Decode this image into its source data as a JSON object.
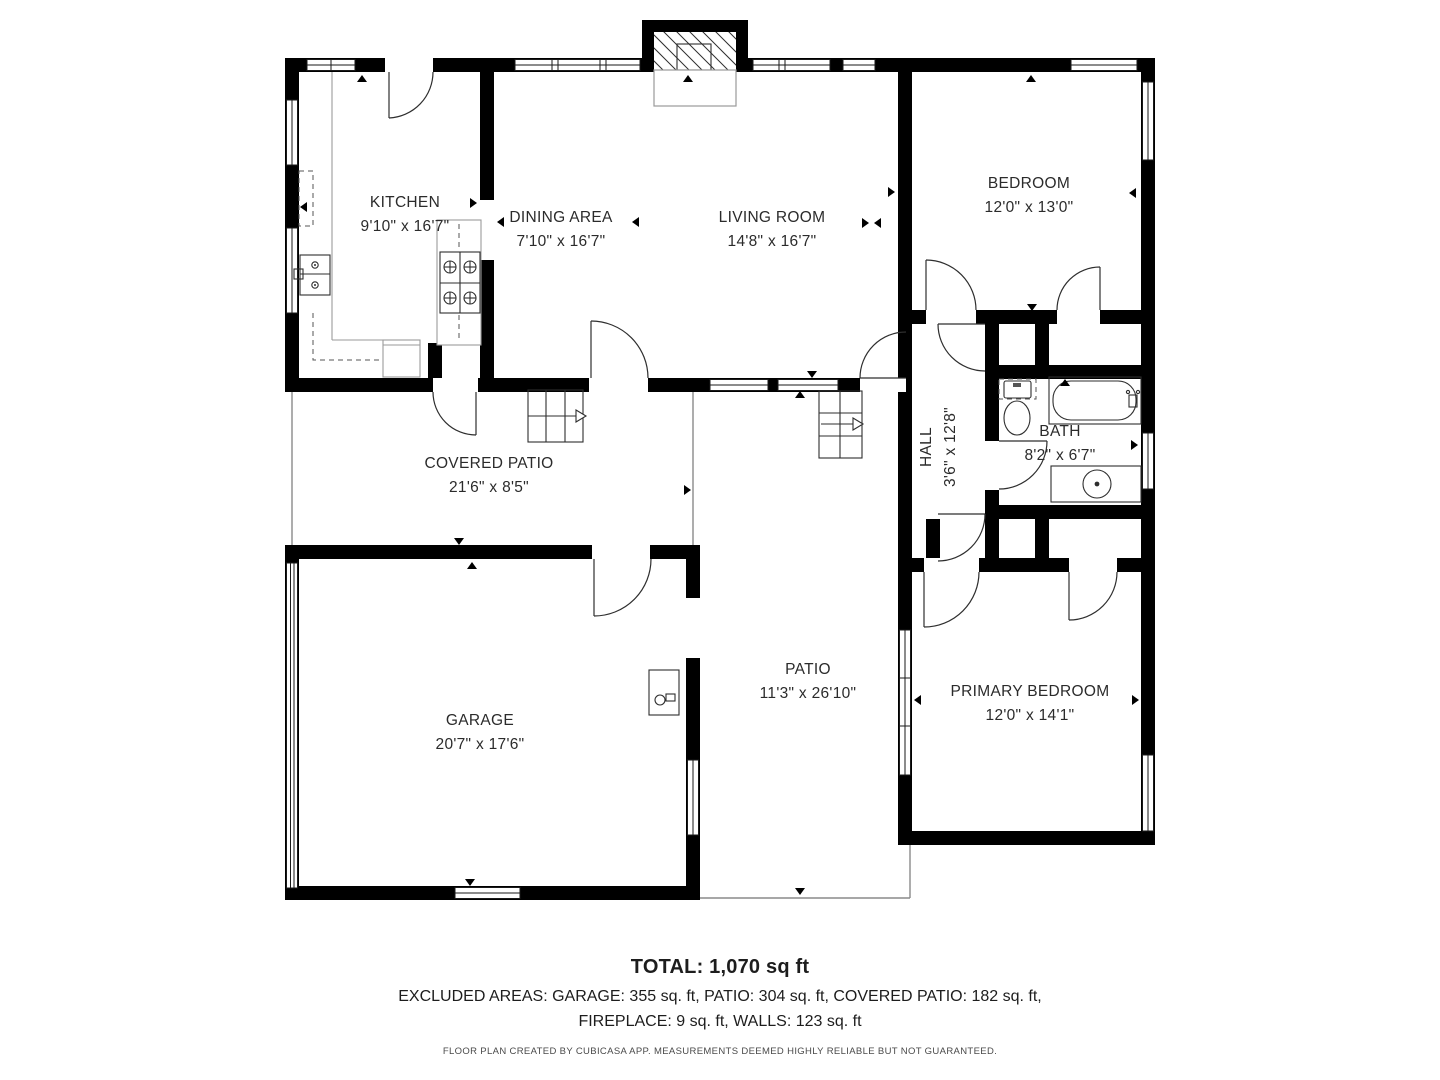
{
  "colors": {
    "wall": "#000000",
    "text": "#2b2b2b",
    "accent_line": "#8a8a8a"
  },
  "rooms": {
    "kitchen": {
      "name": "KITCHEN",
      "dims": "9'10\" x 16'7\""
    },
    "dining": {
      "name": "DINING AREA",
      "dims": "7'10\" x 16'7\""
    },
    "living": {
      "name": "LIVING ROOM",
      "dims": "14'8\" x 16'7\""
    },
    "bedroom": {
      "name": "BEDROOM",
      "dims": "12'0\" x 13'0\""
    },
    "hall": {
      "name": "HALL",
      "dims": "3'6\" x 12'8\""
    },
    "bath": {
      "name": "BATH",
      "dims": "8'2\" x 6'7\""
    },
    "covered_patio": {
      "name": "COVERED PATIO",
      "dims": "21'6\" x 8'5\""
    },
    "garage": {
      "name": "GARAGE",
      "dims": "20'7\" x 17'6\""
    },
    "patio": {
      "name": "PATIO",
      "dims": "11'3\" x 26'10\""
    },
    "primary_bedroom": {
      "name": "PRIMARY BEDROOM",
      "dims": "12'0\" x 14'1\""
    }
  },
  "summary": {
    "total": "TOTAL: 1,070 sq ft",
    "excluded_line1": "EXCLUDED AREAS: GARAGE: 355 sq. ft, PATIO: 304 sq. ft, COVERED PATIO: 182 sq. ft,",
    "excluded_line2": "FIREPLACE: 9 sq. ft, WALLS: 123 sq. ft",
    "disclaimer": "FLOOR PLAN CREATED BY CUBICASA APP. MEASUREMENTS DEEMED HIGHLY RELIABLE BUT NOT GUARANTEED."
  }
}
